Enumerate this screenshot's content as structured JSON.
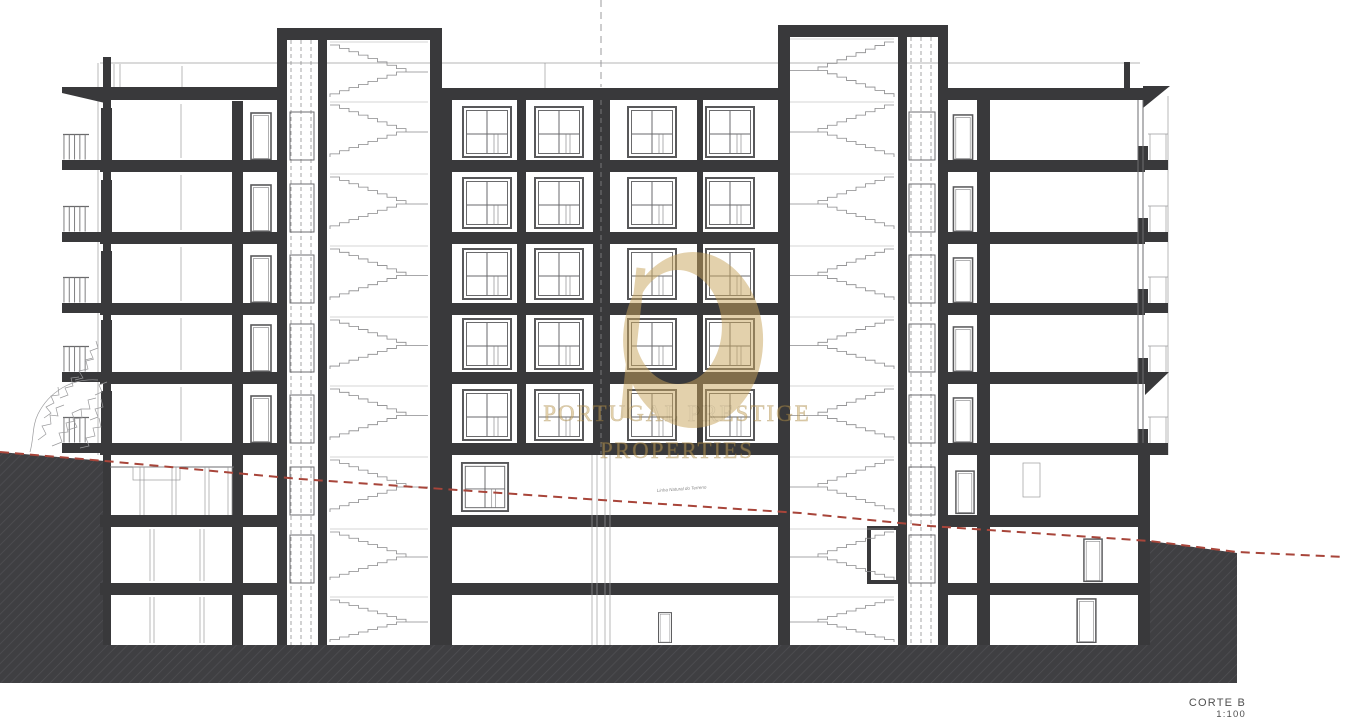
{
  "document": {
    "type_label": "CORTE B",
    "scale": "1:100"
  },
  "watermark": {
    "line1": "PORTUGAL PRESTIGE",
    "line2": "PROPERTIES"
  },
  "annotations": {
    "terrain_line": "Linha Natural do Terreno"
  },
  "colors": {
    "ink": "#39393b",
    "terrain": "#3f3f42",
    "terrain_hatch": "#505054",
    "line": "#6e6e70",
    "line_light": "#9b9b9d",
    "red": "#a8453a",
    "gold": "#c8a45c",
    "label": "#4f4f4f",
    "paper": "#ffffff"
  }
}
